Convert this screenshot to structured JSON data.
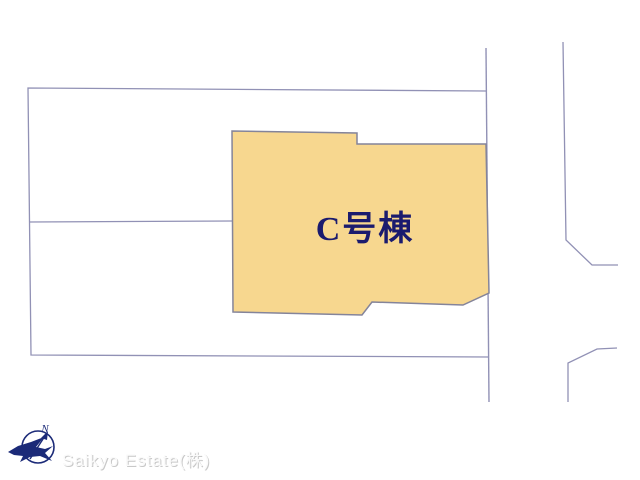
{
  "diagram": {
    "plot_label": "C号棟",
    "watermark": "Saikyo Estate(株)",
    "compass_north_label": "N"
  },
  "colors": {
    "background": "#ffffff",
    "parcel_line": "#9191b5",
    "plot_fill": "#f7d78f",
    "plot_outline": "#84849a",
    "label_navy": "#1b1b6e",
    "compass_navy": "#1b2a78",
    "watermark_light": "#fafafa",
    "watermark_shadow": "#c8c8c8"
  }
}
